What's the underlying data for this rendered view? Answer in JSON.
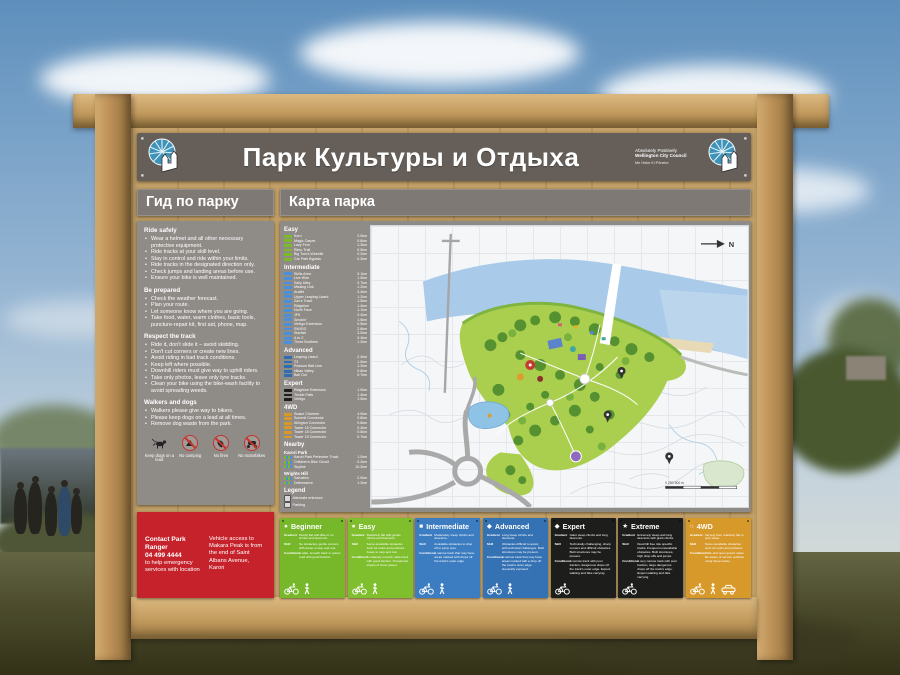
{
  "sign": {
    "title": "Парк Культуры и Отдыха",
    "council": {
      "line1": "Absolutely Positively",
      "line2": "Wellington City Council",
      "line3": "Me Heke Ki Pōneke"
    }
  },
  "guide": {
    "title": "Гид по парку",
    "sections": [
      {
        "heading": "Ride safely",
        "items": [
          "Wear a helmet and all other necessary protective equipment.",
          "Ride tracks at your skill level.",
          "Stay in control and ride within your limits.",
          "Ride tracks in the designated direction only.",
          "Check jumps and landing areas before use.",
          "Ensure your bike is well maintained."
        ]
      },
      {
        "heading": "Be prepared",
        "items": [
          "Check the weather forecast.",
          "Plan your route.",
          "Let someone know where you are going.",
          "Take food, water, warm clothes, basic tools, puncture-repair kit, first aid, phone, map."
        ]
      },
      {
        "heading": "Respect the track",
        "items": [
          "Ride it, don't slide it – avoid skidding.",
          "Don't cut corners or create new lines.",
          "Avoid riding in bad track conditions.",
          "Keep left where possible.",
          "Downhill riders must give way to uphill riders.",
          "Take only photos, leave only tyre tracks.",
          "Clean your bike using the bike-wash facility to avoid spreading weeds."
        ]
      },
      {
        "heading": "Walkers and dogs",
        "items": [
          "Walkers please give way to bikers.",
          "Please keep dogs on a lead at all times.",
          "Remove dog waste from the park."
        ]
      }
    ],
    "pictograms": {
      "dogs": "Keep dogs on a lead",
      "camping": "No camping",
      "fires": "No fires",
      "motorbikes": "No motorbikes"
    }
  },
  "contact": {
    "title": "Contact Park Ranger",
    "phone": "04 499 4444",
    "note": "to help emergency services with location",
    "access": "Vehicle access to Makara Peak is from the end of Saint Albans Avenue, Karori"
  },
  "map": {
    "title": "Карта парка",
    "north_label": "N",
    "scale_label": "0      250      500 m",
    "legend": {
      "title": "Legend",
      "items": [
        "Alternate entrance",
        "Parking",
        "Emergency vehicle access",
        "Lookout",
        "Pylon or Tower",
        "Toilet",
        "Under construction",
        "Track direction (one way / two way)"
      ]
    }
  },
  "trail_lists": {
    "easy": {
      "label": "Easy",
      "color": "#7db928",
      "trails": [
        {
          "name": "Koru",
          "dist": "2.0km"
        },
        {
          "name": "Magic Carpet",
          "dist": "0.6km"
        },
        {
          "name": "Lazy Fern",
          "dist": "1.3km"
        },
        {
          "name": "Rimu Trail",
          "dist": "0.9km"
        },
        {
          "name": "Big Tom's Wheelie",
          "dist": "0.2km"
        },
        {
          "name": "Car Park Bypass",
          "dist": "0.3km"
        }
      ]
    },
    "intermediate": {
      "label": "Intermediate",
      "color": "#4a90d9",
      "trails": [
        {
          "name": "Skills Area",
          "dist": "0.1km"
        },
        {
          "name": "Live Wire",
          "dist": "1.0km"
        },
        {
          "name": "Sally Alley",
          "dist": "0.7km"
        },
        {
          "name": "Missing Link",
          "dist": "1.2km"
        },
        {
          "name": "Aratihi",
          "dist": "3.4km"
        },
        {
          "name": "Upper Leaping Lizard",
          "dist": "1.2km"
        },
        {
          "name": "Zac's Track",
          "dist": "1.5km"
        },
        {
          "name": "Ridgeline",
          "dist": "1.4km"
        },
        {
          "name": "North Face",
          "dist": "1.1km"
        },
        {
          "name": "JFK",
          "dist": "2.4km"
        },
        {
          "name": "Smokin'",
          "dist": "1.6km"
        },
        {
          "name": "Vertigo Extension",
          "dist": "0.5km"
        },
        {
          "name": "SWIGG",
          "dist": "2.6km"
        },
        {
          "name": "Starfish",
          "dist": "3.0km"
        },
        {
          "name": "A to Z",
          "dist": "0.4km"
        },
        {
          "name": "Three Brothers",
          "dist": "1.2km"
        }
      ]
    },
    "advanced": {
      "label": "Advanced",
      "color": "#2f6cb0",
      "trails": [
        {
          "name": "Leaping Lizard",
          "dist": "2.4km"
        },
        {
          "name": "T3",
          "dist": "1.0km"
        },
        {
          "name": "Possum Bait Line",
          "dist": "1.2km"
        },
        {
          "name": "Nikau Valley",
          "dist": "0.6km"
        },
        {
          "name": "Bail Out",
          "dist": "0.7km"
        }
      ]
    },
    "expert": {
      "label": "Expert",
      "color": "#1d1d1b",
      "trails": [
        {
          "name": "Ridgeline Extension",
          "dist": "1.0km"
        },
        {
          "name": "Trickle Falls",
          "dist": "1.4km"
        },
        {
          "name": "Vertigo",
          "dist": "1.0km"
        }
      ]
    },
    "fourwd": {
      "label": "4WD",
      "color": "#d6992a",
      "trails": [
        {
          "name": "Snake Charmer",
          "dist": "4.0km"
        },
        {
          "name": "Summit Connector",
          "dist": "0.8km"
        },
        {
          "name": "Allington Connector",
          "dist": "0.6km"
        },
        {
          "name": "Tower 16 Connector",
          "dist": "0.4km"
        },
        {
          "name": "Tower 18 Connector",
          "dist": "0.5km"
        },
        {
          "name": "Tower 19 Connector",
          "dist": "0.7km"
        }
      ]
    },
    "nearby": {
      "label": "Nearby",
      "sub": [
        {
          "label": "Karori Park",
          "trails": [
            {
              "name": "Karori Park Perimeter Track",
              "dist": "1.0km"
            },
            {
              "name": "Children's Bike Circuit",
              "dist": "0.2km"
            },
            {
              "name": "Skyline",
              "dist": "10.3km"
            }
          ]
        },
        {
          "label": "Wrights Hill",
          "trails": [
            {
              "name": "Salvation",
              "dist": "2.0km"
            },
            {
              "name": "Deliverance",
              "dist": "1.2km"
            }
          ]
        }
      ]
    }
  },
  "grade_labels": {
    "gradient": "Gradient",
    "skill": "Skill",
    "conditions": "Conditions"
  },
  "grades": [
    {
      "name": "Beginner",
      "icon": "●",
      "color": "#76b82a",
      "users": [
        "bike",
        "walk"
      ],
      "gradient": "Mostly flat with little or no climbs and descents.",
      "skill": "No obstacles, gentle corners, with areas to stop and rest.",
      "conditions": "A wide, smooth track or gravel road with good traction."
    },
    {
      "name": "Easy",
      "icon": "●",
      "color": "#7fbe2c",
      "users": [
        "bike",
        "walk"
      ],
      "gradient": "Relatively flat with gentle climbs and descents.",
      "skill": "Some avoidable obstacles such as rocks and potholes. Areas to stop and rest.",
      "conditions": "A relatively smooth, wide track with good traction. Occasional slopes of loose gravel."
    },
    {
      "name": "Intermediate",
      "icon": "■",
      "color": "#3c7dc1",
      "users": [
        "bike",
        "walk"
      ],
      "gradient": "Moderately steep climbs and descents.",
      "skill": "Avoidable obstacles to drop off or jump over.",
      "conditions": "A narrow track that may have areas marked with drops off the track's outer edge."
    },
    {
      "name": "Advanced",
      "icon": "◆",
      "color": "#3572b4",
      "users": [
        "bike",
        "walk"
      ],
      "gradient": "Long steep climbs and descents.",
      "skill": "Obstacles difficult to avoid, with technical challenges. Built structures may be present.",
      "conditions": "A narrow track that may have areas marked with a drop off the track's outer edge. Generally exposed."
    },
    {
      "name": "Expert",
      "icon": "◆",
      "color": "#1d1d1b",
      "users": [
        "bike"
      ],
      "gradient": "Giant steep climbs and long descents.",
      "skill": "Technically challenging, sharp corners and difficult obstacles. Built structures may be present.",
      "conditions": "A narrow track with poor traction, dangerous drops off the track's outer edge. Expect walking and bike carrying."
    },
    {
      "name": "Extreme",
      "icon": "★",
      "color": "#1d1d1b",
      "users": [
        "bike"
      ],
      "gradient": "Extremely steep and long descents with giant climbs.",
      "skill": "Downhill free ride specific tracks. Frequent unavoidable obstacles. Built structures, high drop-offs and jumps.",
      "conditions": "A very narrow track with poor traction, large dangerous drops off the track's edge. Expect walking and bike carrying."
    },
    {
      "name": "4WD",
      "icon": "○",
      "color": "#d6992a",
      "users": [
        "bike",
        "walk",
        "car"
      ],
      "gradient": "Varying from relatively flat to very steep.",
      "skill": "Some avoidable obstacles such as rocks and potholes.",
      "conditions": "Wide and open gravel roads. Be aware of service vehicles using these tracks."
    }
  ]
}
